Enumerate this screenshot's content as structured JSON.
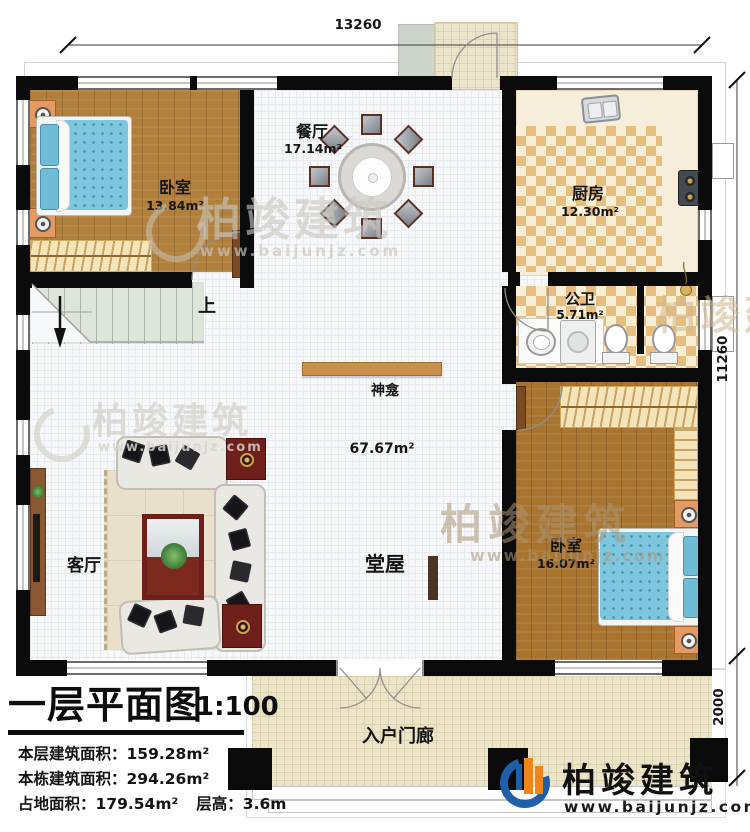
{
  "title_block": {
    "title": "一层平面图",
    "scale": "1:100",
    "stats": [
      {
        "label": "本层建筑面积：",
        "value": "159.28m²"
      },
      {
        "label": "本栋建筑面积：",
        "value": "294.26m²"
      },
      {
        "label": "占地面积：",
        "value": "179.54m²",
        "label2": "层高：",
        "value2": "3.6m"
      }
    ]
  },
  "dimensions": {
    "top": "13260",
    "right": "11260",
    "right_lower": "2000"
  },
  "rooms": {
    "bedroom1": {
      "name": "卧室",
      "area": "13.84m²"
    },
    "dining": {
      "name": "餐厅",
      "area": "17.14m²"
    },
    "kitchen": {
      "name": "厨房",
      "area": "12.30m²"
    },
    "bathroom": {
      "name": "公卫",
      "area": "5.71m²"
    },
    "bedroom2": {
      "name": "卧室",
      "area": "16.07m²"
    },
    "living": {
      "name": "客厅"
    },
    "hall": {
      "name": "堂屋",
      "area": "67.67m²"
    },
    "porch": {
      "name": "入户门廊"
    }
  },
  "annotations": {
    "stairs_up": "上",
    "altar": "神龛"
  },
  "brand": {
    "name": "柏竣建筑",
    "url": "www.baijunjz.com"
  },
  "colors": {
    "wall": "#0b0b0b",
    "wood": "#b1803c",
    "checker_tan": "#e6bf80",
    "logo_blue": "#1d5fa8",
    "logo_orange": "#f08519"
  }
}
